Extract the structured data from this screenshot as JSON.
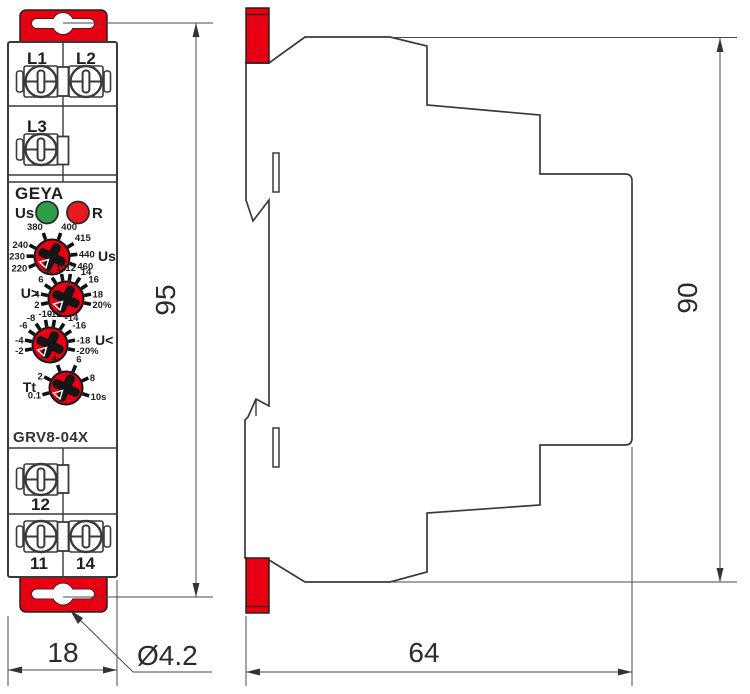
{
  "front_view": {
    "brand": "GEYA",
    "model": "GRV8-04X",
    "led_indicators": [
      {
        "label": "Us",
        "color": "#2f9e47"
      },
      {
        "label": "R",
        "color": "#e8191f"
      }
    ],
    "terminals": {
      "top_row": [
        "L1",
        "L2"
      ],
      "second_row": [
        "L3"
      ],
      "output_single": [
        "12"
      ],
      "output_row": [
        "11",
        "14"
      ]
    },
    "dials": [
      {
        "id": "supply-voltage",
        "side_label": "Us",
        "values": [
          "220",
          "230",
          "240",
          "380",
          "400",
          "415",
          "440",
          "460"
        ]
      },
      {
        "id": "overvoltage-threshold",
        "side_label": "U>",
        "values": [
          "2",
          "4",
          "6",
          "8",
          "10",
          "12",
          "14",
          "16",
          "18",
          "20%"
        ]
      },
      {
        "id": "undervoltage-threshold",
        "side_label": "U<",
        "values": [
          "-2",
          "-4",
          "-6",
          "-8",
          "-10",
          "-12",
          "-14",
          "-16",
          "-18",
          "-20%"
        ]
      },
      {
        "id": "time-delay",
        "side_label": "Tt",
        "values": [
          "0.1",
          "2",
          "4",
          "6",
          "8",
          "10s"
        ]
      }
    ]
  },
  "dimensions": {
    "front_height": "95",
    "front_width": "18",
    "mounting_hole_diameter": "Ø4.2",
    "side_height": "90",
    "side_depth": "64"
  },
  "colors": {
    "accent_red": "#e60012",
    "led_green": "#2f9e47",
    "led_red": "#e8191f",
    "line": "#3a3a3a",
    "dim_line": "#4a4a4a"
  }
}
